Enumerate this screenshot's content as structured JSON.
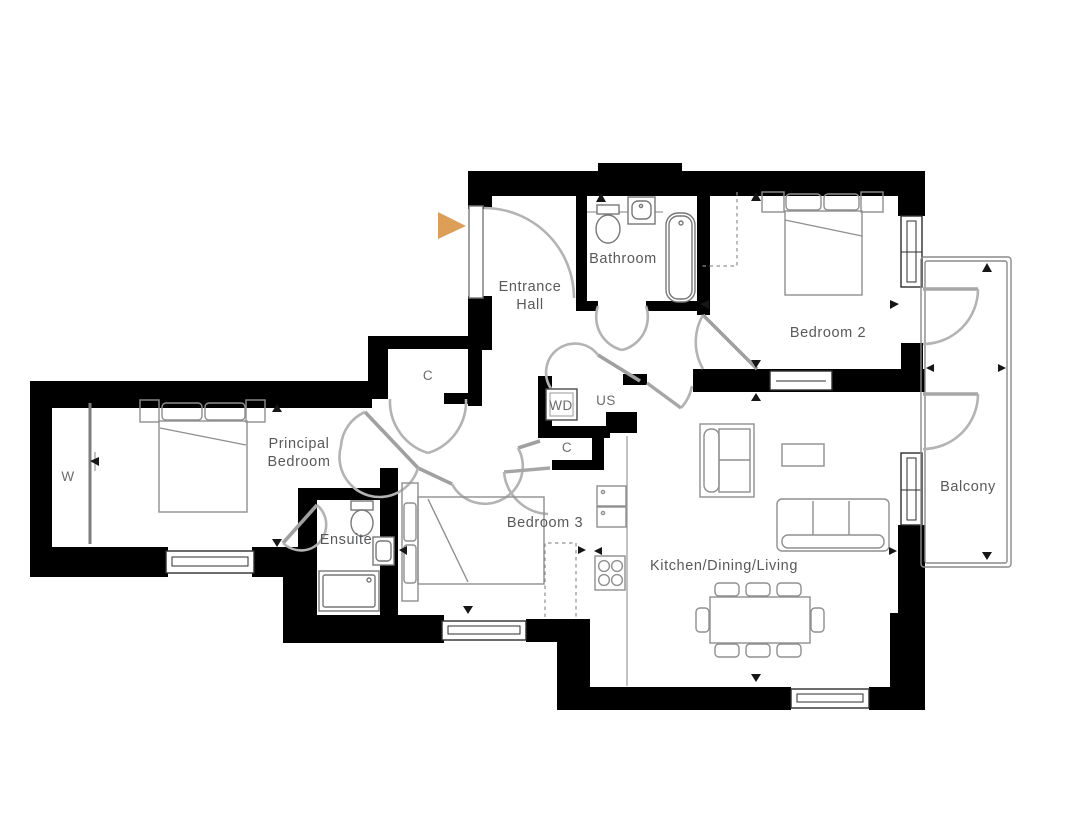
{
  "plan": {
    "type": "apartment-floor-plan",
    "rooms": {
      "entrance_hall": {
        "name": "Entrance Hall",
        "label_line1": "Entrance",
        "label_line2": "Hall"
      },
      "bathroom": {
        "name": "Bathroom"
      },
      "bedroom_2": {
        "name": "Bedroom 2"
      },
      "principal_bedroom": {
        "name": "Principal Bedroom",
        "label_line1": "Principal",
        "label_line2": "Bedroom"
      },
      "bedroom_3": {
        "name": "Bedroom 3"
      },
      "ensuite": {
        "name": "Ensuite"
      },
      "kitchen_dining_living": {
        "name": "Kitchen/Dining/Living"
      },
      "balcony": {
        "name": "Balcony"
      }
    },
    "storage": {
      "hall_closet": "C",
      "washer_dryer": "WD",
      "utility_store": "US",
      "cupboard": "C",
      "wardrobe": "W"
    },
    "colors": {
      "wall": "#000000",
      "label": "#58595b",
      "entrance_arrow": "#DD9E57",
      "background": "#ffffff"
    }
  }
}
